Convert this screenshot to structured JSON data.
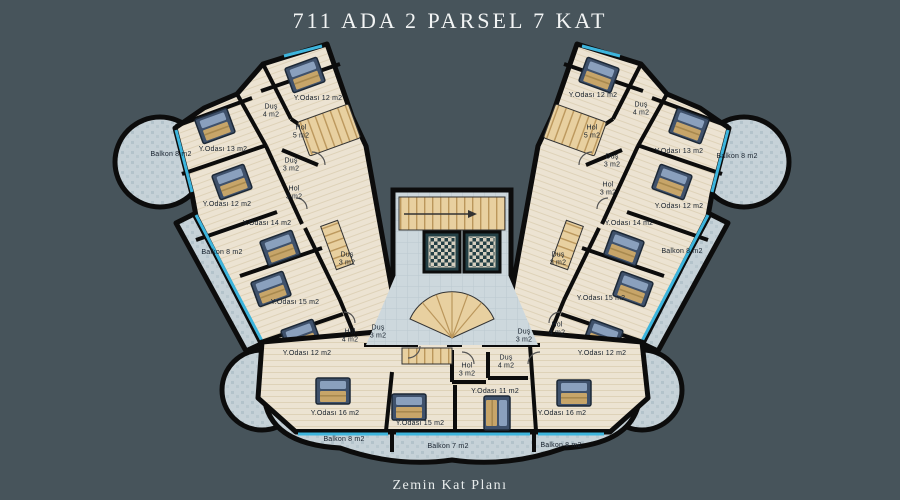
{
  "title": "711  ADA 2 PARSEL 7 KAT",
  "caption": "Zemin Kat Planı",
  "colors": {
    "background": "#47545b",
    "walls": "#0c0c0c",
    "room_floor": "#ece3d2",
    "balcony_floor": "#c6d2d8",
    "lobby_tile": "#cdd8dd",
    "window_accent": "#3db5dd",
    "stairs": "#e8d0a0",
    "elevator_cabin": "#244046",
    "bed": "#3f516b",
    "label_text": "#16202c",
    "title_text": "#f2f4f4"
  },
  "plan": {
    "building": "711 Ada 2 Parsel",
    "floors": "7 Kat",
    "floor_shown": "Zemin Kat",
    "labels": [
      {
        "area": "left-wing",
        "text": "Y.Odası 12 m2",
        "x": 318,
        "y": 99
      },
      {
        "area": "left-wing",
        "text": "Duş\n4 m2",
        "x": 271,
        "y": 112
      },
      {
        "area": "left-wing",
        "text": "Hol\n5 m2",
        "x": 301,
        "y": 133
      },
      {
        "area": "left-wing",
        "text": "Y.Odası 13 m2",
        "x": 223,
        "y": 150
      },
      {
        "area": "left-wing",
        "text": "Balkon 8 m2",
        "x": 171,
        "y": 155
      },
      {
        "area": "left-wing",
        "text": "Duş\n3 m2",
        "x": 291,
        "y": 166
      },
      {
        "area": "left-wing",
        "text": "Hol\n3 m2",
        "x": 294,
        "y": 194
      },
      {
        "area": "left-wing",
        "text": "Y.Odası 12 m2",
        "x": 227,
        "y": 205
      },
      {
        "area": "left-wing",
        "text": "Y.Odası 14 m2",
        "x": 267,
        "y": 224
      },
      {
        "area": "left-wing",
        "text": "Balkon 8 m2",
        "x": 222,
        "y": 253
      },
      {
        "area": "left-wing",
        "text": "Duş\n3 m2",
        "x": 347,
        "y": 260
      },
      {
        "area": "left-wing",
        "text": "Y.Odası 15 m2",
        "x": 295,
        "y": 303
      },
      {
        "area": "left-wing",
        "text": "Hol\n4 m2",
        "x": 350,
        "y": 337
      },
      {
        "area": "left-wing",
        "text": "Duş\n3 m2",
        "x": 378,
        "y": 333
      },
      {
        "area": "left-wing",
        "text": "Y.Odası 12 m2",
        "x": 307,
        "y": 354
      },
      {
        "area": "bottom",
        "text": "Y.Odası 16 m2",
        "x": 335,
        "y": 414
      },
      {
        "area": "bottom",
        "text": "Balkon 8 m2",
        "x": 344,
        "y": 440
      },
      {
        "area": "bottom",
        "text": "Hol\n3 m2",
        "x": 467,
        "y": 371
      },
      {
        "area": "bottom",
        "text": "Duş\n4 m2",
        "x": 506,
        "y": 363
      },
      {
        "area": "bottom",
        "text": "Y.Odası 11 m2",
        "x": 495,
        "y": 392
      },
      {
        "area": "bottom",
        "text": "Y.Odası 15 m2",
        "x": 420,
        "y": 424
      },
      {
        "area": "bottom",
        "text": "Balkon 7 m2",
        "x": 448,
        "y": 447
      },
      {
        "area": "right-wing",
        "text": "Y.Odası 12 m2",
        "x": 593,
        "y": 96
      },
      {
        "area": "right-wing",
        "text": "Duş\n4 m2",
        "x": 641,
        "y": 110
      },
      {
        "area": "right-wing",
        "text": "Hol\n5 m2",
        "x": 592,
        "y": 133
      },
      {
        "area": "right-wing",
        "text": "Y.Odası 13 m2",
        "x": 679,
        "y": 152
      },
      {
        "area": "right-wing",
        "text": "Balkon 8 m2",
        "x": 737,
        "y": 157
      },
      {
        "area": "right-wing",
        "text": "Duş\n3 m2",
        "x": 612,
        "y": 162
      },
      {
        "area": "right-wing",
        "text": "Hol\n3 m2",
        "x": 608,
        "y": 190
      },
      {
        "area": "right-wing",
        "text": "Y.Odası 12 m2",
        "x": 679,
        "y": 207
      },
      {
        "area": "right-wing",
        "text": "Y.Odası 14 m2",
        "x": 629,
        "y": 224
      },
      {
        "area": "right-wing",
        "text": "Balkon 8 m2",
        "x": 682,
        "y": 252
      },
      {
        "area": "right-wing",
        "text": "Duş\n3 m2",
        "x": 558,
        "y": 260
      },
      {
        "area": "right-wing",
        "text": "Y.Odası 15 m2",
        "x": 601,
        "y": 299
      },
      {
        "area": "right-wing",
        "text": "Hol\n4 m2",
        "x": 557,
        "y": 330
      },
      {
        "area": "right-wing",
        "text": "Duş\n3 m2",
        "x": 524,
        "y": 337
      },
      {
        "area": "right-wing",
        "text": "Y.Odası 12 m2",
        "x": 602,
        "y": 354
      },
      {
        "area": "bottom",
        "text": "Y.Odası 16 m2",
        "x": 562,
        "y": 414
      },
      {
        "area": "bottom",
        "text": "Balkon 8 m2",
        "x": 561,
        "y": 446
      }
    ]
  }
}
